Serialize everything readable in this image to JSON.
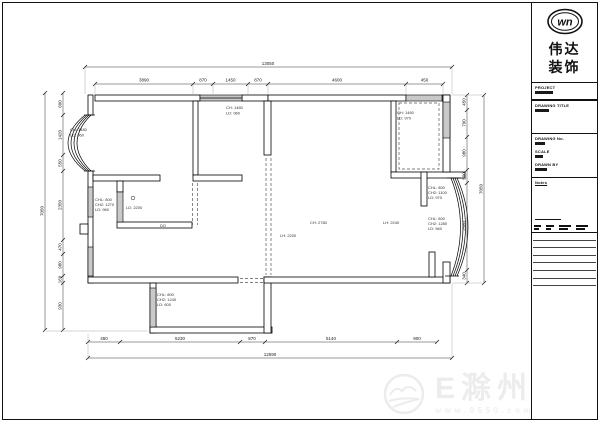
{
  "logo": {
    "monogram": "wn",
    "line1": "伟达",
    "line2": "装饰"
  },
  "title_block": {
    "project_label": "PROJECT",
    "drawing_title_label": "DRAWING TITLE",
    "drawing_no_label": "DRAWING No.",
    "scale_label": "SCALE",
    "drawn_by_label": "DRAWN BY",
    "notes_label": "Notes"
  },
  "watermark": {
    "site_name": "E滁州",
    "site_url": "www.0550.com"
  },
  "plan": {
    "dims": {
      "top_total": "13050",
      "top_segments": [
        "3890",
        "870",
        "1450",
        "870",
        "4600",
        "450"
      ],
      "bottom_total": "12590",
      "bottom_segments": [
        "450",
        "5230",
        "870",
        "5140",
        "900"
      ],
      "left_total": "7050",
      "left_segments": [
        "600",
        "1420",
        "550",
        "2350",
        "470",
        "980",
        "160",
        "930"
      ],
      "right_total": "7050",
      "right_segments": [
        "450",
        "790",
        "980",
        "500",
        "2580",
        "340"
      ]
    },
    "annotations": {
      "left_bay": [
        "CH: 1480",
        "LD: 960"
      ],
      "top_mid_window": [
        "CH: 1460",
        "LD: 960"
      ],
      "closet_window": [
        "CH: 1460",
        "LD: 970"
      ],
      "left_mid_window": [
        "CHL: 800",
        "CH2: 1270",
        "LD: 960"
      ],
      "kitchen_opening": [
        "LD: 2200"
      ],
      "door_tag": "DO",
      "balcony_window": [
        "CHL: 800",
        "CH2: 1240",
        "LD: 600"
      ],
      "living_height": [
        "CH: 2780"
      ],
      "living_beam": [
        "LH: 2240"
      ],
      "dining_beam": [
        "LH: 2200"
      ],
      "right_top_window": [
        "CHL: 800",
        "CH2: 1100",
        "LD: 970"
      ],
      "right_bay_window": [
        "CHL: 800",
        "CH2: 1280",
        "LD: 560"
      ]
    }
  }
}
